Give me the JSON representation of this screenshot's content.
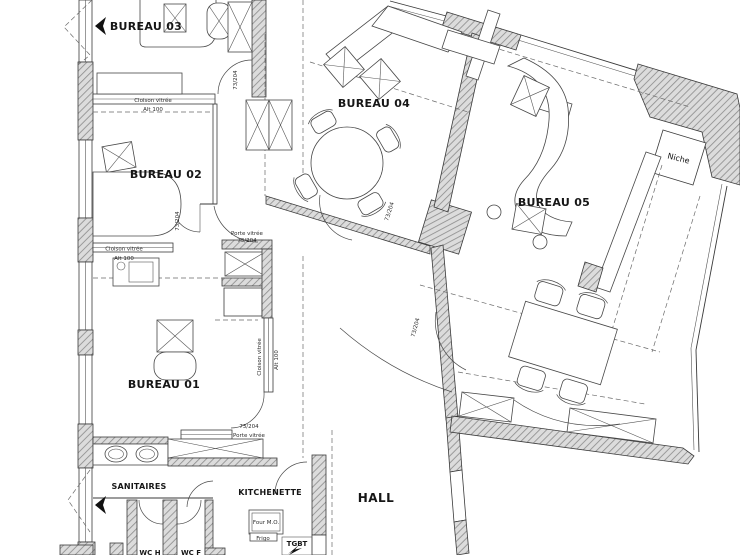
{
  "plan": {
    "rooms": {
      "bureau01": "BUREAU 01",
      "bureau02": "BUREAU 02",
      "bureau03": "BUREAU 03",
      "bureau04": "BUREAU 04",
      "bureau05": "BUREAU 05",
      "sanitaires": "SANITAIRES",
      "kitchenette": "KITCHENETTE",
      "hall": "HALL",
      "wc_h": "WC H",
      "wc_f": "WC F",
      "niche": "Niche",
      "tgbt": "TGBT"
    },
    "labels": {
      "cloison_vitree": "Cloison vitrée",
      "alt_100": "Alt 100",
      "porte_vitree": "Porte vitrée",
      "door_dim": "73/204",
      "four_mo": "Four M.O.",
      "frigo": "Frigo"
    },
    "colors": {
      "line": "#3a3a3a",
      "wall_fill": "#dcdcdc",
      "background": "#ffffff"
    }
  }
}
